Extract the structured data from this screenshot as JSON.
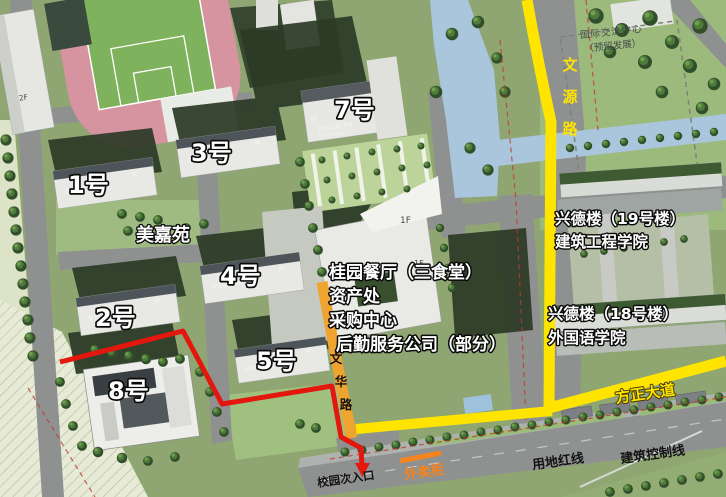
{
  "colors": {
    "route_red": "#E3170D",
    "road_yellow": "#FFE400",
    "road_orange": "#EFA42F",
    "accent_orange": "#F5831E"
  },
  "labels": {
    "intl_center": {
      "line1": "国际交流中心",
      "line2": "（预留发展）"
    },
    "wenyuan_road": {
      "chars": [
        "文",
        "源",
        "路"
      ]
    },
    "wenhua_road": {
      "chars": [
        "文",
        "华",
        "路"
      ]
    },
    "xingde19": {
      "line1": "兴德楼（19号楼）",
      "line2": "建筑工程学院"
    },
    "xingde18": {
      "line1": "兴德楼（18号楼）",
      "line2": "外国语学院"
    },
    "canteen_block": {
      "line1": "桂园餐厅（三食堂）",
      "line2": "资产处",
      "line3": "采购中心",
      "line4": "后勤服务公司（部分）"
    },
    "meijiayuan": "美嘉苑",
    "fangzheng_avenue": "方正大道",
    "campus_entrance": "校园次入口",
    "takeout_cabinet": "外卖柜",
    "land_red_line": "用地红线",
    "building_control_line": "建筑控制线"
  },
  "buildings": {
    "gym": {
      "floors": "2F"
    },
    "b1": {
      "label": "1号",
      "roof": "学生公寓1#楼",
      "floors": "9F"
    },
    "b2": {
      "label": "2号",
      "roof": "学生公寓2#楼",
      "floors": "9F"
    },
    "b3": {
      "label": "3号",
      "roof": "学生公寓3#楼",
      "floors": "9F"
    },
    "b4": {
      "label": "4号",
      "roof": "学生公寓4#楼",
      "floors": "9F"
    },
    "b5": {
      "label": "5号",
      "roof": "学生公寓5#楼",
      "floors": "6F"
    },
    "b7": {
      "label": "7号",
      "roof": "学生公寓7#楼",
      "floors": "9F",
      "height": "H=32.55m"
    },
    "b8": {
      "label": "8号"
    },
    "canteen": {
      "floors": "1F"
    }
  }
}
